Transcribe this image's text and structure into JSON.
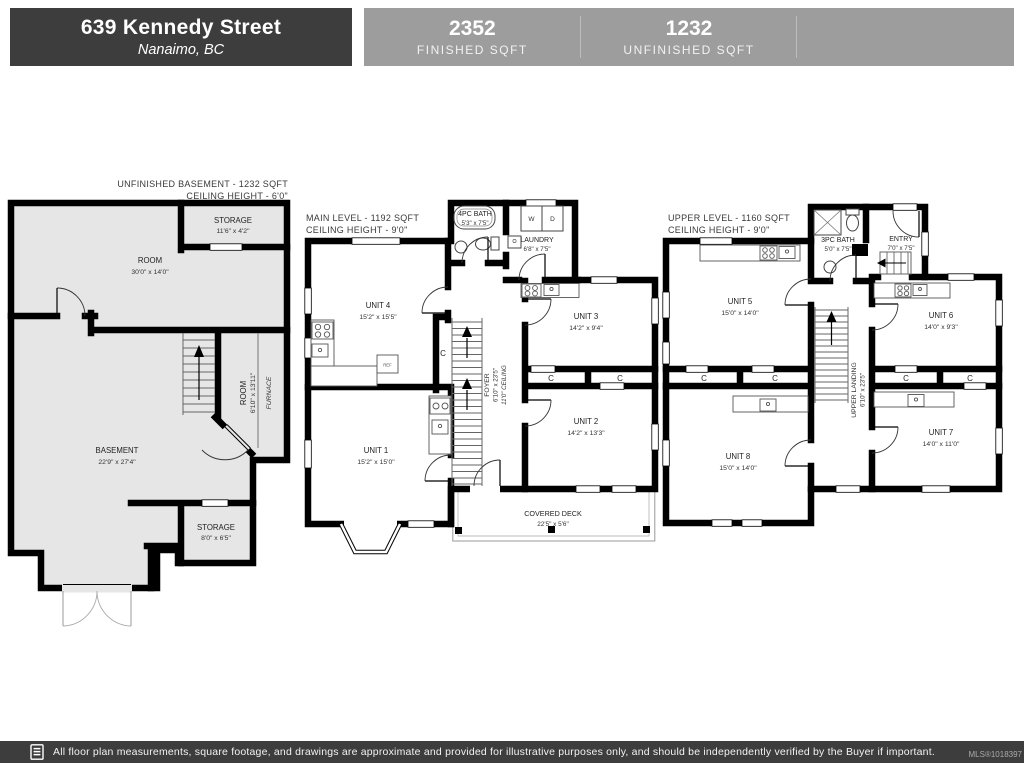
{
  "header": {
    "address": "639 Kennedy Street",
    "city": "Nanaimo, BC",
    "stats": [
      {
        "value": "2352",
        "label": "FINISHED SQFT"
      },
      {
        "value": "1232",
        "label": "UNFINISHED SQFT"
      }
    ]
  },
  "plans": {
    "basement": {
      "title": "UNFINISHED BASEMENT - 1232 SQFT",
      "ceiling": "CEILING HEIGHT - 6'0\"",
      "rooms": {
        "storage_top": {
          "name": "STORAGE",
          "dims": "11'6\" x 4'2\""
        },
        "room": {
          "name": "ROOM",
          "dims": "30'0\" x 14'0\""
        },
        "basement": {
          "name": "BASEMENT",
          "dims": "22'9\" x 27'4\""
        },
        "side_room": {
          "name": "ROOM",
          "dims": "6'10\" x 13'11\""
        },
        "furnace": {
          "name": "FURNACE"
        },
        "storage_bottom": {
          "name": "STORAGE",
          "dims": "8'0\" x 6'5\""
        }
      }
    },
    "main": {
      "title": "MAIN LEVEL - 1192 SQFT",
      "ceiling": "CEILING HEIGHT - 9'0\"",
      "rooms": {
        "bath": {
          "name": "4PC BATH",
          "dims": "5'3\" x 7'5\""
        },
        "laundry": {
          "name": "LAUNDRY",
          "dims": "6'8\" x 7'5\""
        },
        "washer": "W",
        "dryer": "D",
        "unit4": {
          "name": "UNIT 4",
          "dims": "15'2\" x 15'5\""
        },
        "unit3": {
          "name": "UNIT 3",
          "dims": "14'2\" x 9'4\""
        },
        "unit2": {
          "name": "UNIT 2",
          "dims": "14'2\" x 13'3\""
        },
        "unit1": {
          "name": "UNIT 1",
          "dims": "15'2\" x 15'0\""
        },
        "foyer": {
          "name": "FOYER",
          "dims": "6'10\" x 23'5\"",
          "note": "11'0\" CEILING"
        },
        "deck": {
          "name": "COVERED DECK",
          "dims": "22'5\" x 5'6\""
        },
        "fridge": "REF",
        "closet": "C"
      }
    },
    "upper": {
      "title": "UPPER LEVEL - 1160 SQFT",
      "ceiling": "CEILING HEIGHT - 9'0\"",
      "rooms": {
        "bath": {
          "name": "3PC BATH",
          "dims": "5'0\" x 7'5\""
        },
        "entry": {
          "name": "ENTRY",
          "dims": "7'0\" x 7'5\""
        },
        "unit5": {
          "name": "UNIT 5",
          "dims": "15'0\" x 14'0\""
        },
        "unit6": {
          "name": "UNIT 6",
          "dims": "14'0\" x 9'3\""
        },
        "unit7": {
          "name": "UNIT 7",
          "dims": "14'0\" x 11'0\""
        },
        "unit8": {
          "name": "UNIT 8",
          "dims": "15'0\" x 14'0\""
        },
        "landing": {
          "name": "UPPER LANDING",
          "dims": "6'10\" x 23'5\""
        },
        "closet": "C"
      }
    }
  },
  "footer": {
    "disclaimer": "All floor plan measurements, square footage, and drawings are approximate and provided for illustrative purposes only, and should be independently verified by the Buyer if important.",
    "mls": "MLS®1018397"
  },
  "colors": {
    "header_dark": "#3d3d3d",
    "header_light": "#9d9d9d",
    "unfinished_fill": "#e6e6e6",
    "wall": "#000000"
  }
}
